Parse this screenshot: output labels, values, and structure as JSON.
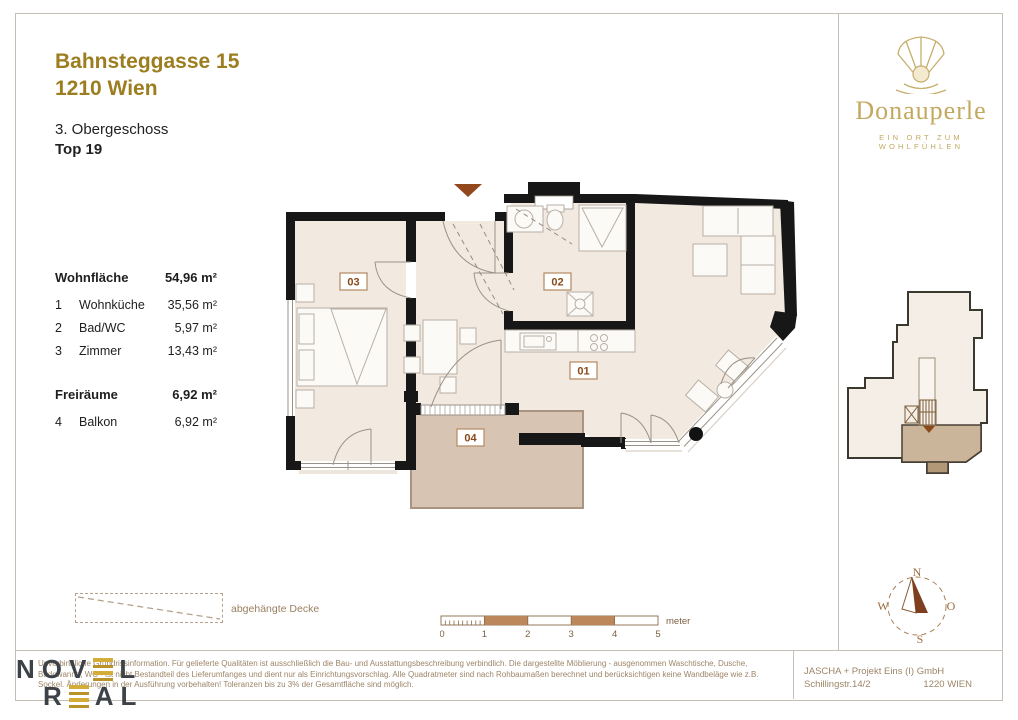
{
  "header": {
    "address_line1": "Bahnsteggasse 15",
    "address_line2": "1210 Wien",
    "floor": "3. Obergeschoss",
    "unit": "Top 19"
  },
  "brand": {
    "name": "Donauperle",
    "tagline": "EIN ORT ZUM WOHLFÜHLEN"
  },
  "area_table": {
    "groups": [
      {
        "label": "Wohnfläche",
        "value": "54,96 m²",
        "rows": [
          {
            "no": "1",
            "name": "Wohnküche",
            "value": "35,56 m²"
          },
          {
            "no": "2",
            "name": "Bad/WC",
            "value": "5,97 m²"
          },
          {
            "no": "3",
            "name": "Zimmer",
            "value": "13,43 m²"
          }
        ]
      },
      {
        "label": "Freiräume",
        "value": "6,92 m²",
        "rows": [
          {
            "no": "4",
            "name": "Balkon",
            "value": "6,92 m²"
          }
        ]
      }
    ]
  },
  "floorplan": {
    "labels": [
      "01",
      "02",
      "03",
      "04"
    ]
  },
  "legend": {
    "label": "abgehängte Decke"
  },
  "scalebar": {
    "ticks": [
      "0",
      "1",
      "2",
      "3",
      "4",
      "5"
    ],
    "unit": "meter"
  },
  "compass": {
    "north": "N",
    "east": "O",
    "south": "S",
    "west": "W"
  },
  "footer": {
    "disclaimer_lines": [
      "Unverbindliche Grundrissinformation. Für gelieferte Qualitäten ist ausschließlich die Bau- und Ausstattungsbeschreibung verbindlich. Die dargestellte Möblierung - ausgenommen Waschtische, Dusche,",
      "Badewanne, WC - ist nicht Bestandteil des Lieferumfanges und dient nur als Einrichtungsvorschlag. Alle Quadratmeter sind nach Rohbaumaßen berechnet und berücksichtigen keine Wandbeläge wie z.B.",
      "Sockel. Änderungen in der Ausführung vorbehalten! Toleranzen bis zu 3% der Gesamtfläche sind möglich."
    ],
    "company_line1": "JASCHA + Projekt Eins (I) GmbH",
    "company_street": "Schillingstr.14/2",
    "company_city": "1220 WIEN"
  },
  "logo": {
    "word1_pre": "NOV",
    "word1_post": "L",
    "word2_pre": "R",
    "word2_post": "AL"
  },
  "colors": {
    "accent_gold": "#9c7d1f",
    "brand_gold": "#c3a95f",
    "plan_label_brown": "#8a4a1a",
    "footer_brown": "#9d8568",
    "wall_black": "#171717",
    "room_fill": "#f2e9e1",
    "balcony_fill": "#d7c4b3",
    "scale_fill": "#bb875b"
  }
}
